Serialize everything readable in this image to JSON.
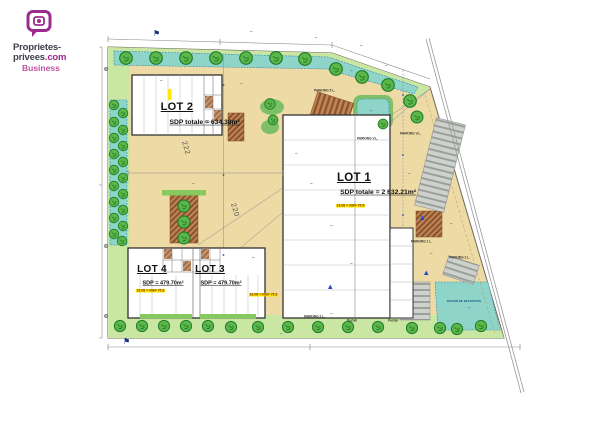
{
  "logo": {
    "line1": "Proprietes-",
    "line2_dark": "privees",
    "line2_accent": ".com",
    "tagline": "Business"
  },
  "plan": {
    "lot1": {
      "title": "LOT 1",
      "sdp": "SDP totale = 2 632.21m²",
      "level": "16.08 = NGF 75.6"
    },
    "lot2": {
      "title": "LOT 2",
      "sdp": "SDP totale = 634.38m²"
    },
    "lot3": {
      "title": "LOT 3",
      "sdp": "SDP = 479.70m²",
      "level": "16.08 = NGF 75.6"
    },
    "lot4": {
      "title": "LOT 4",
      "sdp": "SDP = 479.70m²",
      "level": "16.08 = NGF 75.6"
    },
    "labels": {
      "parking_vl": "PARKING V.L.",
      "parking_2l": "PARKING 2 L.",
      "parking_5l": "PARKING 5 L.",
      "portail": "Portail",
      "bassin": "BASSIN DE RETENTION",
      "contour_a": "222",
      "contour_b": "220"
    },
    "icons": {
      "flag_marker": "⚑"
    },
    "colors": {
      "paving": "#eedaa4",
      "lawn": "#c9e6a2",
      "basin": "#8fd4c8",
      "tree": "#5cb648",
      "highlight": "#ffe800",
      "brand": "#9c2b8f"
    }
  }
}
